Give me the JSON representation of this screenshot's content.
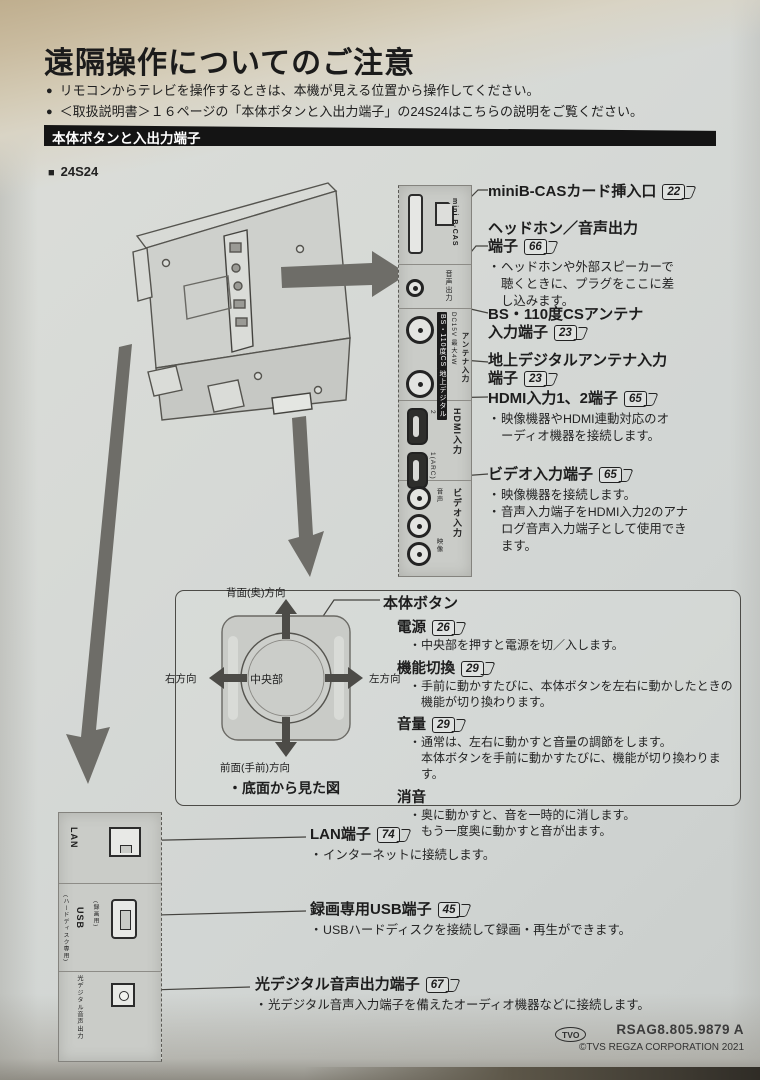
{
  "header": {
    "title": "遠隔操作についてのご注意",
    "notes": [
      "リモコンからテレビを操作するときは、本機が見える位置から操作してください。",
      "＜取扱説明書＞１６ページの「本体ボタンと入出力端子」の24S24はこちらの説明をご覧ください。"
    ],
    "section_bar": "本体ボタンと入出力端子",
    "model": "24S24"
  },
  "rear_panel": {
    "bcas_label": "mini B-CAS",
    "headphone_label": "音声出力",
    "bs_chip": "BS・110度CS",
    "dc_label": "DC15V 最大4W",
    "terr_chip": "地上デジタル",
    "antenna_label": "アンテナ入力",
    "hdmi_label": "HDMI入力",
    "hdmi_port2": "2",
    "hdmi_port1": "1(ARC)",
    "video_label": "ビデオ入力",
    "audio_label": "音声",
    "composite_label": "映像"
  },
  "terminals": [
    {
      "title": "miniB-CASカード挿入口",
      "page": "22"
    },
    {
      "title": "ヘッドホン／音声出力",
      "title2": "端子",
      "page": "66",
      "notes": [
        "ヘッドホンや外部スピーカーで聴くときに、プラグをここに差し込みます。"
      ]
    },
    {
      "title": "BS・110度CSアンテナ",
      "title2": "入力端子",
      "page": "23"
    },
    {
      "title": "地上デジタルアンテナ入力",
      "title2": "端子",
      "page": "23"
    },
    {
      "title": "HDMI入力1、2端子",
      "page": "65",
      "notes": [
        "映像機器やHDMI連動対応のオーディオ機器を接続します。"
      ]
    },
    {
      "title": "ビデオ入力端子",
      "page": "65",
      "notes": [
        "映像機器を接続します。",
        "音声入力端子をHDMI入力2のアナログ音声入力端子として使用できます。"
      ]
    }
  ],
  "body_button": {
    "header": "本体ボタン",
    "diagram": {
      "top": "背面(奥)方向",
      "bottom": "前面(手前)方向",
      "left": "右方向",
      "right": "左方向",
      "center": "中央部",
      "caption": "・底面から見た図"
    },
    "items": [
      {
        "title": "電源",
        "page": "26",
        "notes": [
          "中央部を押すと電源を切／入します。"
        ]
      },
      {
        "title": "機能切換",
        "page": "29",
        "notes": [
          "手前に動かすたびに、本体ボタンを左右に動かしたときの機能が切り換わります。"
        ]
      },
      {
        "title": "音量",
        "page": "29",
        "notes": [
          "通常は、左右に動かすと音量の調節をします。",
          "本体ボタンを手前に動かすたびに、機能が切り換わります。"
        ]
      },
      {
        "title": "消音",
        "notes": [
          "奥に動かすと、音を一時的に消します。",
          "もう一度奥に動かすと音が出ます。"
        ]
      }
    ]
  },
  "bottom_panel": {
    "lan_label": "LAN",
    "usb_label": "USB",
    "usb_note1": "(録画用)",
    "usb_note2": "(ハードディスク専用)",
    "optical_label": "光デジタル音声出力"
  },
  "bottom_terminals": [
    {
      "title": "LAN端子",
      "page": "74",
      "notes": [
        "インターネットに接続します。"
      ]
    },
    {
      "title": "録画専用USB端子",
      "page": "45",
      "notes": [
        "USBハードディスクを接続して録画・再生ができます。"
      ]
    },
    {
      "title": "光デジタル音声出力端子",
      "page": "67",
      "notes": [
        "光デジタル音声入力端子を備えたオーディオ機器などに接続します。"
      ]
    }
  ],
  "footer": {
    "mark": "TVO",
    "code": "RSAG8.805.9879 A",
    "copyright": "©TVS REGZA CORPORATION 2021"
  }
}
